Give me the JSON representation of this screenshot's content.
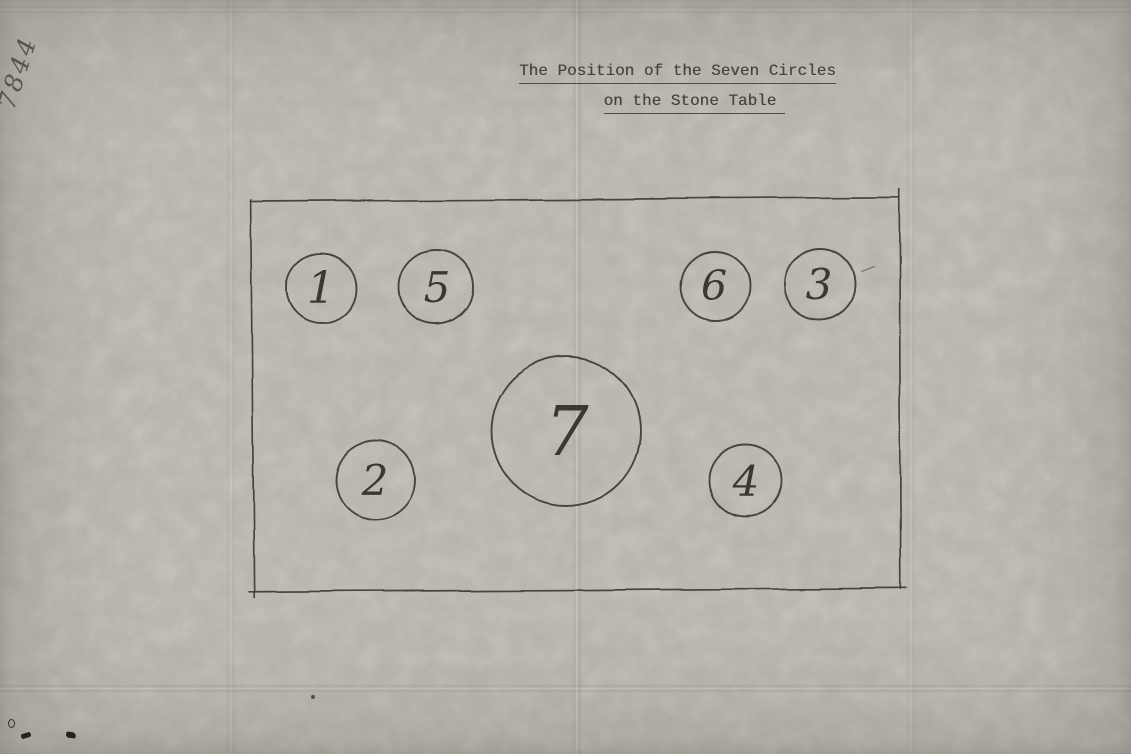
{
  "title": {
    "line1": "The Position of the Seven Circles",
    "line2": "on the Stone Table"
  },
  "corner_annotation": "7844",
  "diagram": {
    "shape": "hand-drawn rectangle (the Stone Table) containing seven hand-drawn circles",
    "circles": [
      {
        "number": "1",
        "position": "top-left",
        "size": "small"
      },
      {
        "number": "5",
        "position": "top-left-inner",
        "size": "small"
      },
      {
        "number": "6",
        "position": "top-right-inner",
        "size": "small"
      },
      {
        "number": "3",
        "position": "top-right",
        "size": "small"
      },
      {
        "number": "7",
        "position": "center",
        "size": "large"
      },
      {
        "number": "2",
        "position": "bottom-left",
        "size": "small"
      },
      {
        "number": "4",
        "position": "bottom-right",
        "size": "small"
      }
    ]
  },
  "colors": {
    "paper": "#b6b3aa",
    "typewriter_ink": "#45423a",
    "pencil_ink": "#3b382f"
  }
}
